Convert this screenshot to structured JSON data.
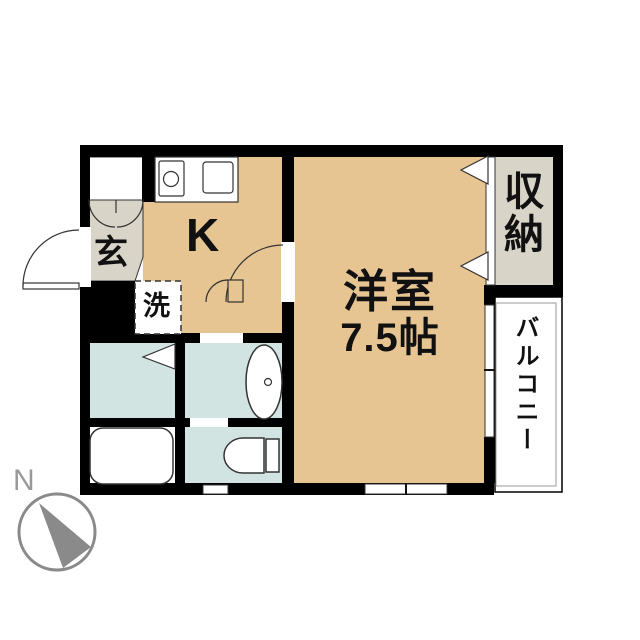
{
  "floorplan": {
    "rooms": {
      "genkan": {
        "label": "玄"
      },
      "kitchen": {
        "label": "K"
      },
      "laundry": {
        "label": "洗"
      },
      "main_room": {
        "label": "洋室",
        "size": "7.5帖"
      },
      "closet": {
        "label": "収納"
      },
      "balcony": {
        "label": "バルコニー"
      }
    },
    "compass": {
      "north_label": "N"
    },
    "fixtures": [
      "kitchen-counter",
      "stove-burner",
      "kitchen-sink",
      "washbasin",
      "bathtub",
      "toilet",
      "entrance-cabinet"
    ],
    "colors": {
      "floor_tan": "#e6c592",
      "entry_closet_gray": "#d8d4c8",
      "wet_area_blue": "#d2e4e2",
      "wall_black": "#000000",
      "compass_gray": "#8a8a8a"
    }
  }
}
